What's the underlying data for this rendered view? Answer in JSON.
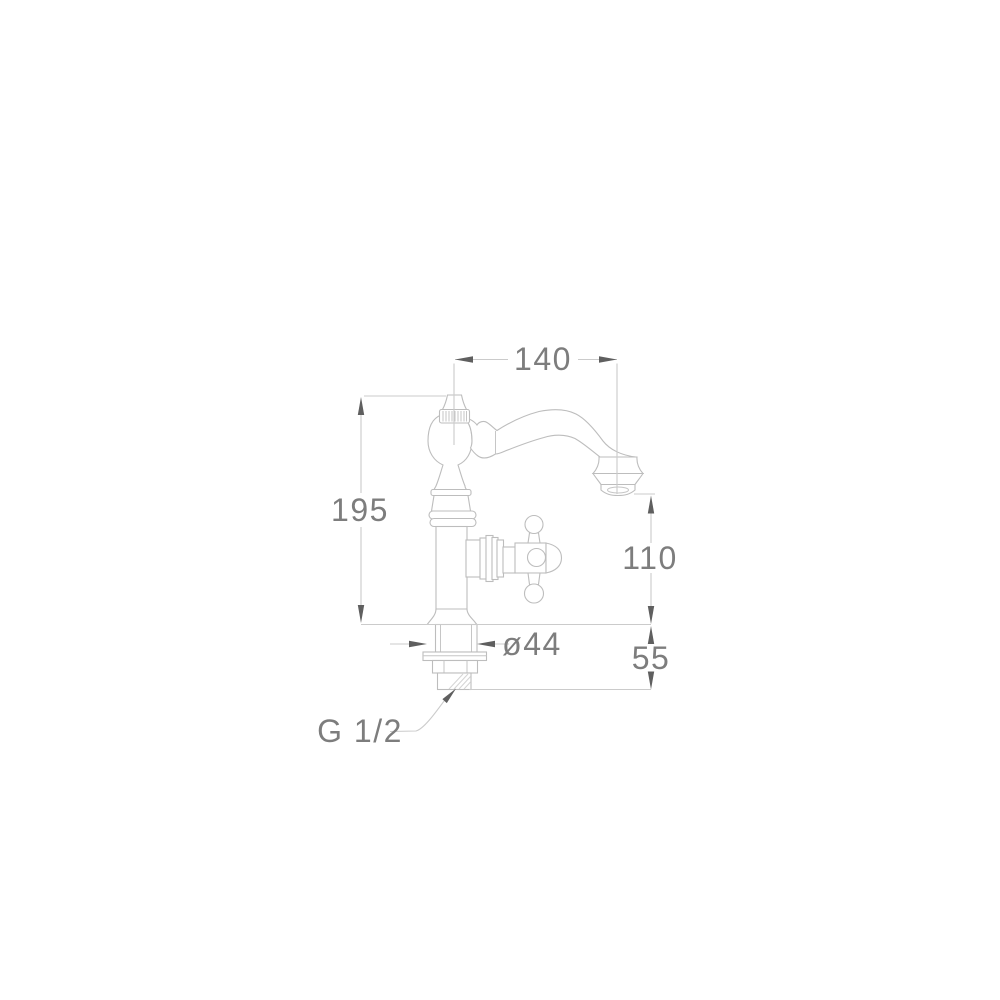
{
  "diagram": {
    "kind": "technical-line-drawing",
    "subject": "classic single-hole pillar basin tap, side elevation with dimensions",
    "units": "mm",
    "colors": {
      "background": "#ffffff",
      "part_outline": "#bdbdbd",
      "dimension_line": "#cbcbcb",
      "arrowhead": "#5f5f5f",
      "dimension_text": "#7d7d7d"
    },
    "dimensions": [
      {
        "name": "spout-reach",
        "value": "140",
        "orientation": "horizontal"
      },
      {
        "name": "overall-height",
        "value": "195",
        "orientation": "vertical"
      },
      {
        "name": "outlet-height",
        "value": "110",
        "orientation": "vertical"
      },
      {
        "name": "under-deck-length",
        "value": "55",
        "orientation": "vertical"
      },
      {
        "name": "base-diameter",
        "value": "ø44",
        "orientation": "horizontal"
      },
      {
        "name": "inlet-thread",
        "value": "G 1/2",
        "orientation": "leader"
      }
    ]
  }
}
